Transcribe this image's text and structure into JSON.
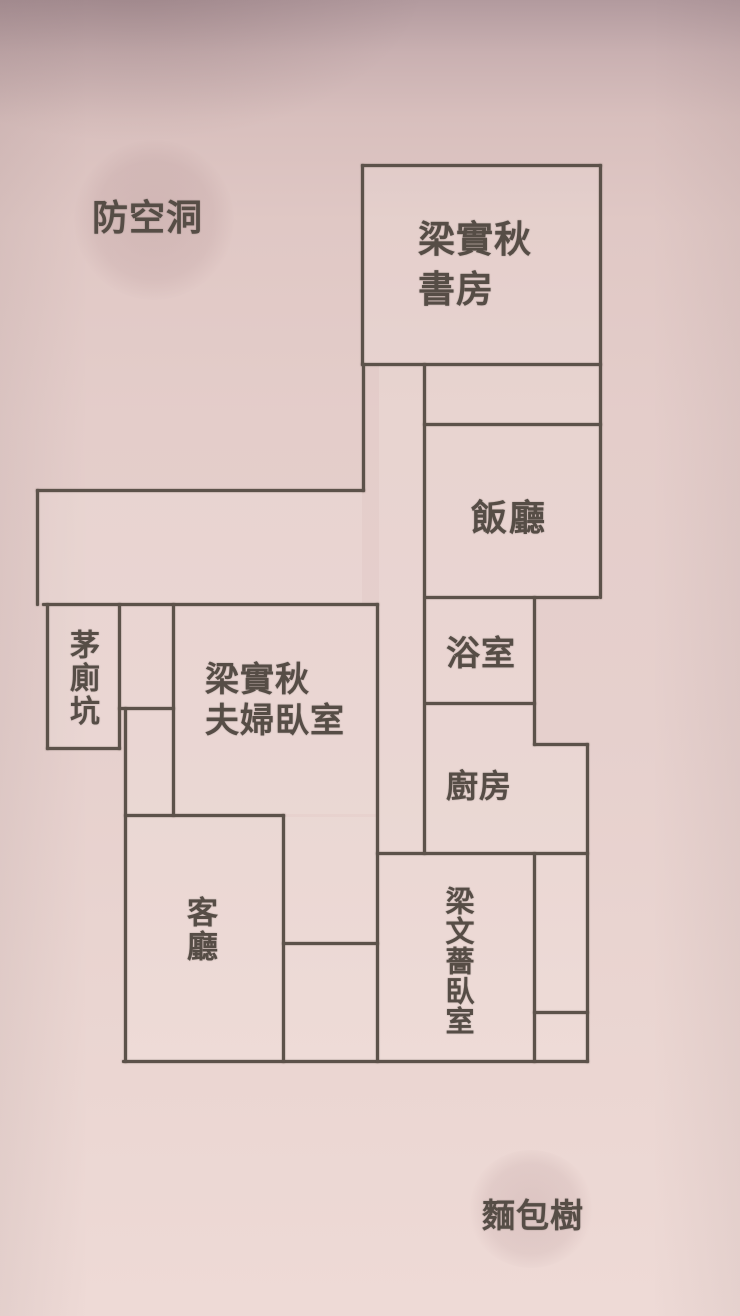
{
  "colors": {
    "wall_background": "#e4cdca",
    "plan_line": "#5c524a",
    "text": "#564d46"
  },
  "floorplan": {
    "rooms": [
      {
        "id": "study",
        "label": "梁實秋書房",
        "display": "梁實秋\n書房"
      },
      {
        "id": "dining-room",
        "label": "飯廳"
      },
      {
        "id": "bathroom",
        "label": "浴室"
      },
      {
        "id": "kitchen",
        "label": "廚房"
      },
      {
        "id": "latrine-pit",
        "label": "茅廁坑"
      },
      {
        "id": "master-bedroom",
        "label": "梁實秋夫婦臥室",
        "display": "梁實秋\n夫婦臥室"
      },
      {
        "id": "living-room",
        "label": "客廳"
      },
      {
        "id": "daughter-bedroom",
        "label": "梁文薔臥室"
      }
    ],
    "landmarks": [
      {
        "id": "air-raid-shelter",
        "label": "防空洞"
      },
      {
        "id": "breadfruit-tree",
        "label": "麵包樹"
      }
    ]
  }
}
